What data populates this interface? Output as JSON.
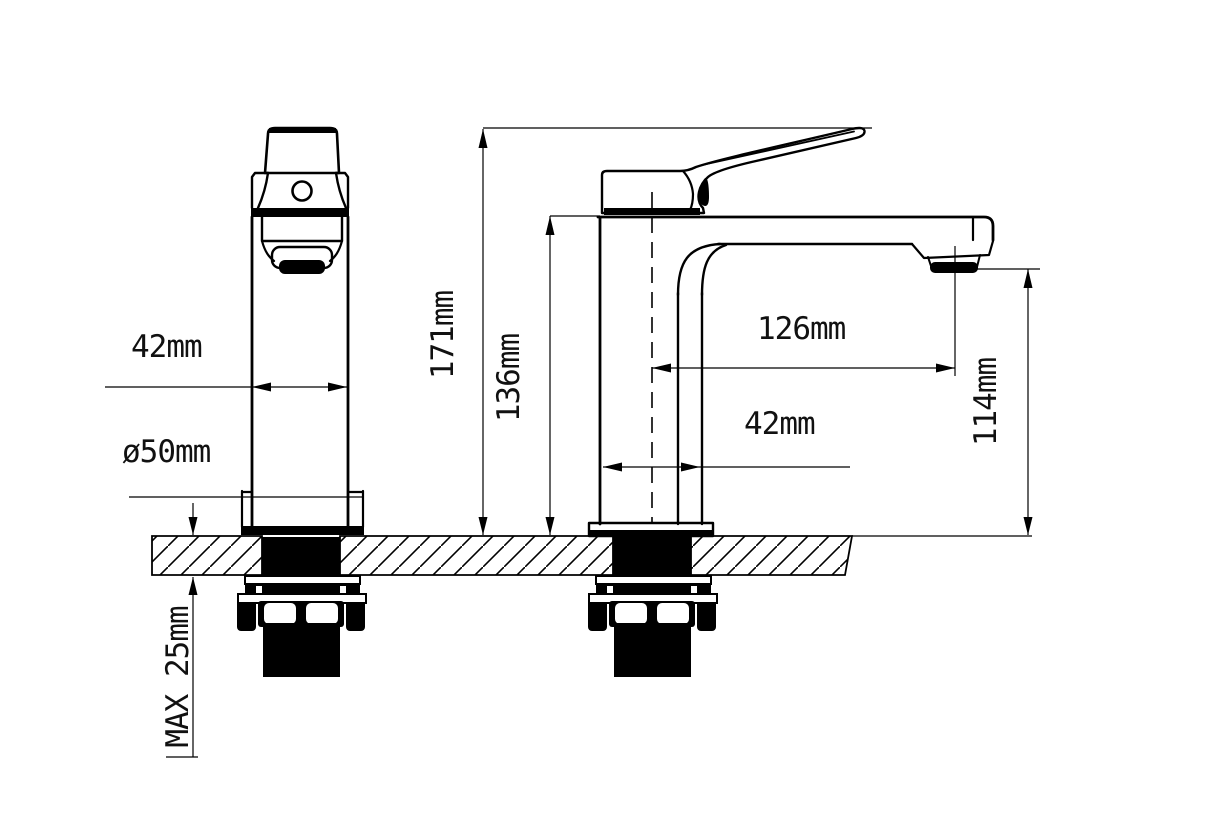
{
  "drawing": {
    "type": "faucet-technical-drawing",
    "line_color": "#000000",
    "background_color": "#ffffff",
    "labels": {
      "front_width": "42mm",
      "base_diameter": "ø50mm",
      "total_height": "171mm",
      "spout_top_height": "136mm",
      "spout_reach": "126mm",
      "body_depth": "42mm",
      "outlet_height": "114mm",
      "max_thickness": "MAX 25mm"
    }
  }
}
